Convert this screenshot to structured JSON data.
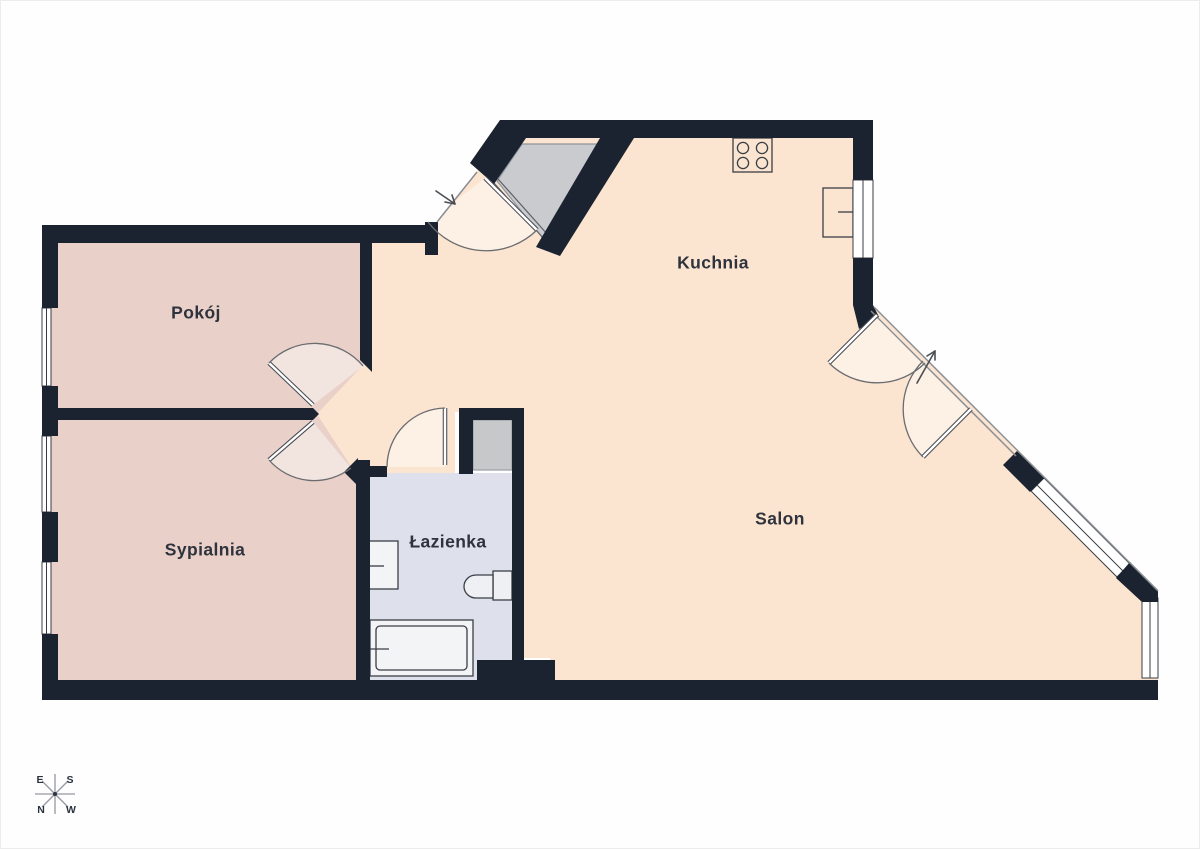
{
  "title": "Apartment floor plan",
  "rooms": [
    {
      "id": "pokoj",
      "label": "Pokój"
    },
    {
      "id": "sypialnia",
      "label": "Sypialnia"
    },
    {
      "id": "lazienka",
      "label": "Łazienka"
    },
    {
      "id": "kuchnia",
      "label": "Kuchnia"
    },
    {
      "id": "salon",
      "label": "Salon"
    }
  ],
  "compass": {
    "east": "E",
    "south": "S",
    "north": "N",
    "west": "W"
  },
  "colors": {
    "wall": "#1a232f",
    "floor_living": "#fce5d0",
    "floor_rooms": "#e9d0c8",
    "floor_bathroom": "#dee1ec",
    "closet_gray": "#c9cbce",
    "shaft_gray": "#c6c8ca",
    "door_swing_highlight": "rgba(255,255,255,0.42)",
    "fixture_stroke": "#3a3f46"
  },
  "icons": {
    "stove": "stove-icon",
    "radiator": "radiator-icon",
    "sink": "sink-icon",
    "toilet": "toilet-icon",
    "bathtub": "bathtub-icon",
    "wardrobe": "wardrobe-closet",
    "entry_arrow": "entry-arrow-icon",
    "balcony_arrow": "balcony-arrow-icon",
    "compass": "compass-rose-icon"
  }
}
